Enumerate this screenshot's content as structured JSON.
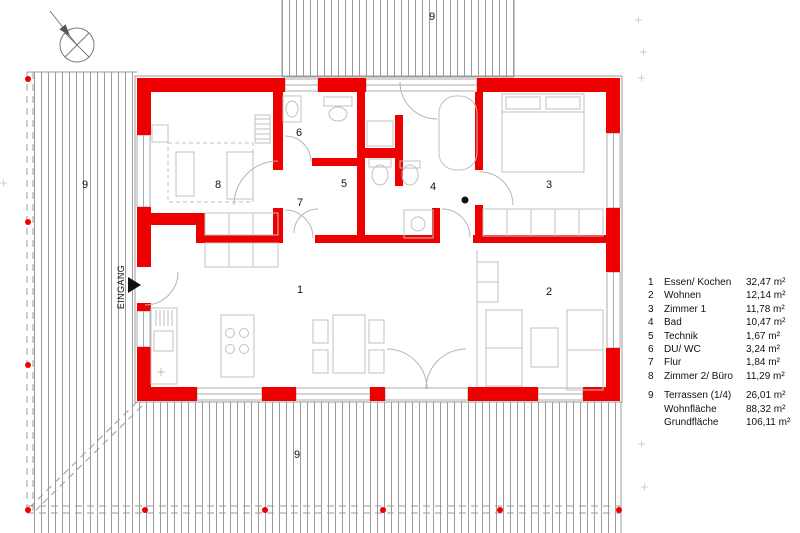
{
  "colors": {
    "red": "#ee0000",
    "hatch": "#9b9b9b",
    "furn": "#c0c0c0",
    "ink": "#111111"
  },
  "entrance": {
    "label": "EINGANG"
  },
  "compass": {
    "icon": "north-arrow"
  },
  "room_markers": [
    {
      "t": "8",
      "x": 218,
      "y": 185
    },
    {
      "t": "6",
      "x": 299,
      "y": 133
    },
    {
      "t": "5",
      "x": 344,
      "y": 184
    },
    {
      "t": "7",
      "x": 300,
      "y": 203
    },
    {
      "t": "4",
      "x": 433,
      "y": 187
    },
    {
      "t": "3",
      "x": 549,
      "y": 185
    },
    {
      "t": "1",
      "x": 300,
      "y": 290
    },
    {
      "t": "2",
      "x": 549,
      "y": 292
    },
    {
      "t": "9",
      "x": 432,
      "y": 17
    },
    {
      "t": "9",
      "x": 85,
      "y": 185
    },
    {
      "t": "9",
      "x": 297,
      "y": 455
    }
  ],
  "legend": {
    "rows": [
      {
        "num": "1",
        "name": "Essen/ Kochen",
        "area": "32,47 m²"
      },
      {
        "num": "2",
        "name": "Wohnen",
        "area": "12,14 m²"
      },
      {
        "num": "3",
        "name": "Zimmer 1",
        "area": "11,78 m²"
      },
      {
        "num": "4",
        "name": "Bad",
        "area": "10,47 m²"
      },
      {
        "num": "5",
        "name": "Technik",
        "area": "1,67 m²"
      },
      {
        "num": "6",
        "name": "DU/ WC",
        "area": "3,24 m²"
      },
      {
        "num": "7",
        "name": "Flur",
        "area": "1,84 m²"
      },
      {
        "num": "8",
        "name": "Zimmer 2/ Büro",
        "area": "11,29 m²"
      },
      {
        "num": "9",
        "name": "Terrassen (1/4)",
        "area": "26,01 m²",
        "gap": true
      },
      {
        "num": "",
        "name": "Wohnfläche",
        "area": "88,32 m²"
      },
      {
        "num": "",
        "name": "Grundfläche",
        "area": "106,11 m²"
      }
    ]
  }
}
